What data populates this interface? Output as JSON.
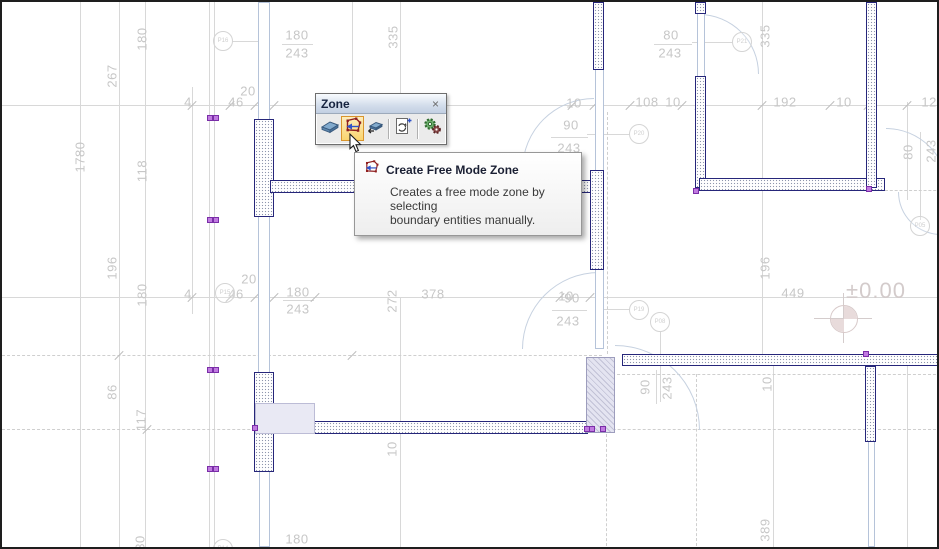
{
  "toolbar": {
    "title": "Zone",
    "close_label": "×",
    "buttons": [
      {
        "name": "create-zone",
        "icon": "zone-box-icon",
        "active": false
      },
      {
        "name": "create-free-mode-zone",
        "icon": "zone-free-mode-icon",
        "active": true
      },
      {
        "name": "create-zone-reference",
        "icon": "zone-box-small-icon",
        "active": false
      },
      {
        "name": "update-zones",
        "icon": "update-zones-icon",
        "active": false
      },
      {
        "name": "zone-settings",
        "icon": "gears-icon",
        "active": false
      }
    ]
  },
  "tooltip": {
    "title": "Create Free Mode Zone",
    "line1": "Creates a free mode zone by selecting",
    "line2": "boundary entities manually."
  },
  "level_marker": {
    "text": "±0.00"
  },
  "colors": {
    "wall_border": "#26267a",
    "window_line": "#b5c3d9",
    "dim_text": "#c7c7c7",
    "highlight_border": "#d9952c",
    "highlight_fill": "#fad46f",
    "level_text": "#d3cbcb",
    "handle": "#c07ae0"
  },
  "plan": {
    "labels": [
      {
        "t": "4",
        "x": 186,
        "y": 100
      },
      {
        "t": "46",
        "x": 234,
        "y": 100
      },
      {
        "t": "20",
        "x": 246,
        "y": 89
      },
      {
        "t": "180",
        "x": 295,
        "y": 33
      },
      {
        "t": "243",
        "x": 295,
        "y": 51
      },
      {
        "t": "335",
        "x": 391,
        "y": 35,
        "r": 1
      },
      {
        "t": "10",
        "x": 572,
        "y": 101
      },
      {
        "t": "90",
        "x": 569,
        "y": 123
      },
      {
        "t": "243",
        "x": 567,
        "y": 146
      },
      {
        "t": "108",
        "x": 645,
        "y": 100
      },
      {
        "t": "10",
        "x": 671,
        "y": 100
      },
      {
        "t": "80",
        "x": 669,
        "y": 33
      },
      {
        "t": "243",
        "x": 668,
        "y": 51
      },
      {
        "t": "192",
        "x": 783,
        "y": 100
      },
      {
        "t": "10",
        "x": 842,
        "y": 100
      },
      {
        "t": "129",
        "x": 931,
        "y": 100
      },
      {
        "t": "335",
        "x": 763,
        "y": 34,
        "r": 1
      },
      {
        "t": "180",
        "x": 140,
        "y": 37,
        "r": 1
      },
      {
        "t": "267",
        "x": 110,
        "y": 74,
        "r": 1
      },
      {
        "t": "1780",
        "x": 78,
        "y": 155,
        "r": 1
      },
      {
        "t": "118",
        "x": 140,
        "y": 169,
        "r": 1
      },
      {
        "t": "196",
        "x": 110,
        "y": 266,
        "r": 1
      },
      {
        "t": "180",
        "x": 140,
        "y": 293,
        "r": 1
      },
      {
        "t": "86",
        "x": 110,
        "y": 390,
        "r": 1
      },
      {
        "t": "117",
        "x": 139,
        "y": 418,
        "r": 1
      },
      {
        "t": "30",
        "x": 138,
        "y": 541,
        "r": 1
      },
      {
        "t": "4",
        "x": 186,
        "y": 292
      },
      {
        "t": "46",
        "x": 234,
        "y": 292
      },
      {
        "t": "20",
        "x": 247,
        "y": 277
      },
      {
        "t": "180",
        "x": 296,
        "y": 290
      },
      {
        "t": "243",
        "x": 296,
        "y": 307
      },
      {
        "t": "272",
        "x": 390,
        "y": 299,
        "r": 1
      },
      {
        "t": "378",
        "x": 431,
        "y": 292
      },
      {
        "t": "10",
        "x": 564,
        "y": 294
      },
      {
        "t": "90",
        "x": 570,
        "y": 296
      },
      {
        "t": "243",
        "x": 566,
        "y": 319
      },
      {
        "t": "196",
        "x": 763,
        "y": 266,
        "r": 1
      },
      {
        "t": "449",
        "x": 791,
        "y": 291
      },
      {
        "t": "90",
        "x": 643,
        "y": 385,
        "r": 1
      },
      {
        "t": "243",
        "x": 665,
        "y": 386,
        "r": 1
      },
      {
        "t": "80",
        "x": 906,
        "y": 150,
        "r": 1
      },
      {
        "t": "243",
        "x": 929,
        "y": 149,
        "r": 1
      },
      {
        "t": "10",
        "x": 765,
        "y": 382,
        "r": 1
      },
      {
        "t": "10",
        "x": 390,
        "y": 447,
        "r": 1
      },
      {
        "t": "389",
        "x": 763,
        "y": 528,
        "r": 1
      },
      {
        "t": "180",
        "x": 295,
        "y": 537
      }
    ],
    "circles": [
      {
        "t": "P16",
        "x": 221,
        "y": 39
      },
      {
        "t": "P21",
        "x": 740,
        "y": 40
      },
      {
        "t": "P20",
        "x": 637,
        "y": 132
      },
      {
        "t": "P15",
        "x": 223,
        "y": 291
      },
      {
        "t": "P19",
        "x": 637,
        "y": 308
      },
      {
        "t": "P08",
        "x": 658,
        "y": 320
      },
      {
        "t": "P05",
        "x": 918,
        "y": 224
      },
      {
        "t": "P14",
        "x": 221,
        "y": 547
      }
    ],
    "walls": [
      {
        "x": 252,
        "y": 117,
        "w": 20,
        "h": 98
      },
      {
        "x": 252,
        "y": 370,
        "w": 20,
        "h": 100
      },
      {
        "x": 268,
        "y": 178,
        "w": 322,
        "h": 13
      },
      {
        "x": 588,
        "y": 168,
        "w": 14,
        "h": 100
      },
      {
        "x": 591,
        "y": 0,
        "w": 11,
        "h": 68
      },
      {
        "x": 693,
        "y": 0,
        "w": 11,
        "h": 12
      },
      {
        "x": 693,
        "y": 74,
        "w": 11,
        "h": 112
      },
      {
        "x": 697,
        "y": 176,
        "w": 186,
        "h": 13
      },
      {
        "x": 864,
        "y": 0,
        "w": 11,
        "h": 186
      },
      {
        "x": 620,
        "y": 352,
        "w": 319,
        "h": 12
      },
      {
        "x": 863,
        "y": 364,
        "w": 11,
        "h": 76
      },
      {
        "x": 311,
        "y": 419,
        "w": 275,
        "h": 13
      }
    ],
    "windows": [
      {
        "x": 256,
        "y": 0,
        "w": 12,
        "h": 118
      },
      {
        "x": 256,
        "y": 214,
        "w": 12,
        "h": 157
      },
      {
        "x": 257,
        "y": 469,
        "w": 11,
        "h": 76
      },
      {
        "x": 593,
        "y": 66,
        "w": 9,
        "h": 104
      },
      {
        "x": 593,
        "y": 267,
        "w": 9,
        "h": 80
      },
      {
        "x": 866,
        "y": 439,
        "w": 7,
        "h": 106
      },
      {
        "x": 695,
        "y": 11,
        "w": 8,
        "h": 64
      }
    ],
    "column": {
      "x": 584,
      "y": 355,
      "w": 29,
      "h": 76
    },
    "zone_rect": {
      "x": 253,
      "y": 401,
      "w": 60,
      "h": 31
    },
    "arcs": [
      {
        "x": 520,
        "y": 96,
        "w": 72,
        "h": 72,
        "c": "tl"
      },
      {
        "x": 697,
        "y": 12,
        "w": 60,
        "h": 60,
        "c": "tr"
      },
      {
        "x": 884,
        "y": 126,
        "w": 62,
        "h": 62,
        "c": "tr"
      },
      {
        "x": 520,
        "y": 270,
        "w": 77,
        "h": 77,
        "c": "tl"
      },
      {
        "x": 613,
        "y": 343,
        "w": 85,
        "h": 85,
        "c": "tr"
      },
      {
        "x": 896,
        "y": 190,
        "w": 43,
        "h": 43,
        "c": "bl"
      }
    ],
    "lines": [
      {
        "x1": 0,
        "y1": 103,
        "x2": 939,
        "y2": 103
      },
      {
        "x1": 0,
        "y1": 295,
        "x2": 939,
        "y2": 295
      },
      {
        "x1": 78,
        "y1": 0,
        "x2": 78,
        "y2": 549
      },
      {
        "x1": 117,
        "y1": 0,
        "x2": 117,
        "y2": 549
      },
      {
        "x1": 143,
        "y1": 0,
        "x2": 143,
        "y2": 549
      },
      {
        "x1": 190,
        "y1": 85,
        "x2": 190,
        "y2": 312
      },
      {
        "x1": 207,
        "y1": 0,
        "x2": 207,
        "y2": 549
      },
      {
        "x1": 212,
        "y1": 0,
        "x2": 212,
        "y2": 549
      },
      {
        "x1": 263,
        "y1": 0,
        "x2": 263,
        "y2": 120
      },
      {
        "x1": 263,
        "y1": 368,
        "x2": 263,
        "y2": 549
      },
      {
        "x1": 350,
        "y1": 0,
        "x2": 350,
        "y2": 103
      },
      {
        "x1": 398,
        "y1": 0,
        "x2": 398,
        "y2": 103
      },
      {
        "x1": 398,
        "y1": 295,
        "x2": 398,
        "y2": 549
      },
      {
        "x1": 760,
        "y1": 0,
        "x2": 760,
        "y2": 352
      },
      {
        "x1": 771,
        "y1": 352,
        "x2": 771,
        "y2": 549
      },
      {
        "x1": 905,
        "y1": 100,
        "x2": 905,
        "y2": 198
      },
      {
        "x1": 905,
        "y1": 352,
        "x2": 905,
        "y2": 549
      },
      {
        "x1": 280,
        "y1": 42,
        "x2": 311,
        "y2": 42
      },
      {
        "x1": 652,
        "y1": 42,
        "x2": 690,
        "y2": 42
      },
      {
        "x1": 549,
        "y1": 135,
        "x2": 586,
        "y2": 135
      },
      {
        "x1": 281,
        "y1": 298,
        "x2": 312,
        "y2": 298
      },
      {
        "x1": 550,
        "y1": 308,
        "x2": 585,
        "y2": 308
      },
      {
        "x1": 654,
        "y1": 368,
        "x2": 654,
        "y2": 402
      },
      {
        "x1": 918,
        "y1": 130,
        "x2": 918,
        "y2": 218
      },
      {
        "x1": 230,
        "y1": 39,
        "x2": 256,
        "y2": 39
      },
      {
        "x1": 690,
        "y1": 40,
        "x2": 731,
        "y2": 40
      },
      {
        "x1": 585,
        "y1": 132,
        "x2": 628,
        "y2": 132
      },
      {
        "x1": 600,
        "y1": 307,
        "x2": 628,
        "y2": 307
      },
      {
        "x1": 658,
        "y1": 330,
        "x2": 658,
        "y2": 400
      },
      {
        "x1": 237,
        "y1": 545,
        "x2": 312,
        "y2": 545
      }
    ],
    "dashed": [
      {
        "x1": 0,
        "y1": 353,
        "x2": 600,
        "y2": 353
      },
      {
        "x1": 595,
        "y1": 372,
        "x2": 939,
        "y2": 372
      },
      {
        "x1": 0,
        "y1": 427,
        "x2": 939,
        "y2": 427
      },
      {
        "x1": 605,
        "y1": 110,
        "x2": 605,
        "y2": 352
      },
      {
        "x1": 604,
        "y1": 432,
        "x2": 604,
        "y2": 549
      },
      {
        "x1": 694,
        "y1": 372,
        "x2": 694,
        "y2": 549
      },
      {
        "x1": 883,
        "y1": 188,
        "x2": 939,
        "y2": 188
      }
    ],
    "ticks": [
      [
        190,
        103
      ],
      [
        228,
        103
      ],
      [
        253,
        103
      ],
      [
        272,
        103
      ],
      [
        570,
        103
      ],
      [
        592,
        103
      ],
      [
        628,
        103
      ],
      [
        680,
        103
      ],
      [
        697,
        103
      ],
      [
        760,
        103
      ],
      [
        828,
        103
      ],
      [
        866,
        103
      ],
      [
        905,
        103
      ],
      [
        190,
        295
      ],
      [
        228,
        295
      ],
      [
        253,
        295
      ],
      [
        272,
        295
      ],
      [
        313,
        295
      ],
      [
        558,
        295
      ],
      [
        588,
        295
      ],
      [
        117,
        353
      ],
      [
        350,
        353
      ],
      [
        145,
        427
      ],
      [
        438,
        427
      ]
    ],
    "handles": [
      [
        208,
        116
      ],
      [
        214,
        116
      ],
      [
        208,
        218
      ],
      [
        214,
        218
      ],
      [
        208,
        368
      ],
      [
        214,
        368
      ],
      [
        208,
        467
      ],
      [
        214,
        467
      ],
      [
        253,
        426
      ],
      [
        585,
        427
      ],
      [
        590,
        427
      ],
      [
        601,
        427
      ],
      [
        694,
        189
      ],
      [
        864,
        352
      ],
      [
        867,
        187
      ]
    ]
  }
}
